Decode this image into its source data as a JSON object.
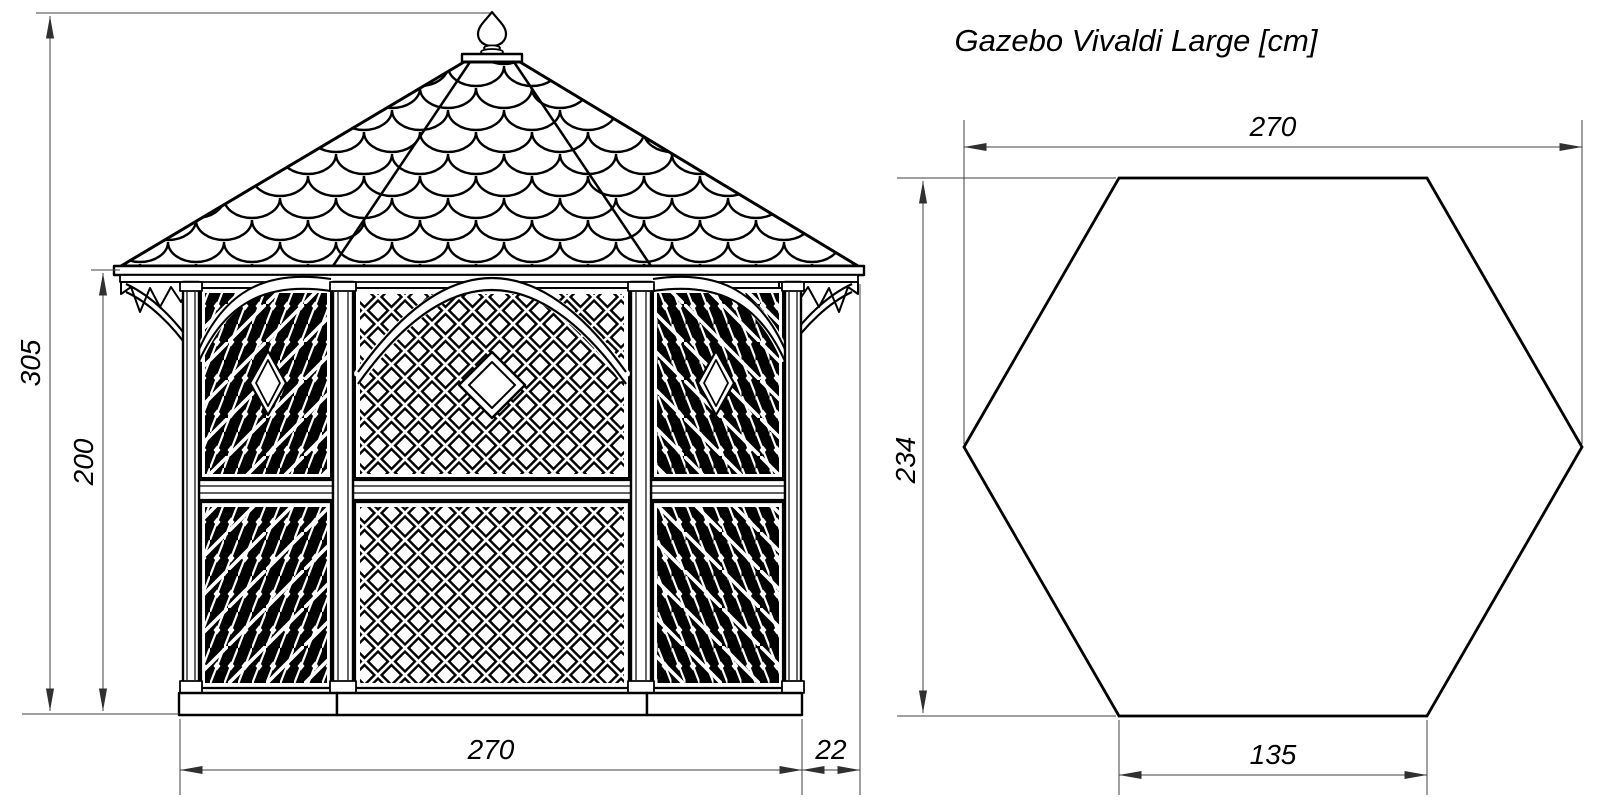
{
  "title": "Gazebo Vivaldi Large [cm]",
  "elevation": {
    "total_height": "305",
    "wall_height": "200",
    "base_width": "270",
    "roof_overhang": "22"
  },
  "plan": {
    "width": "270",
    "depth": "234",
    "side_length": "135"
  },
  "colors": {
    "line": "#000000",
    "dimension_line": "#404040",
    "background": "#ffffff"
  }
}
